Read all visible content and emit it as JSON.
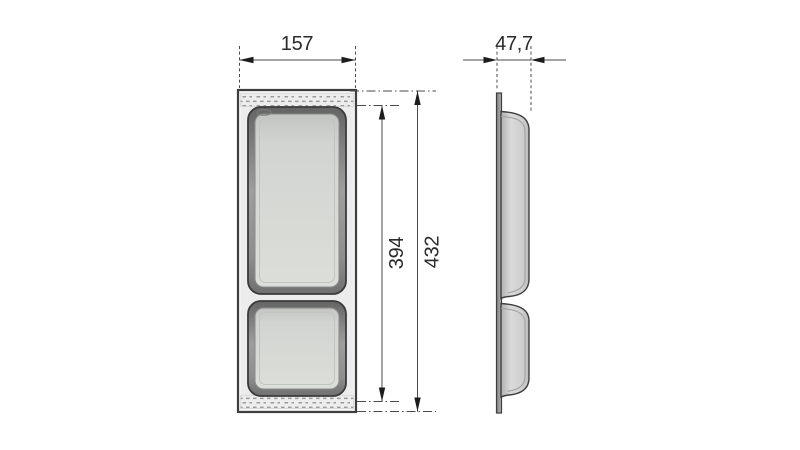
{
  "page": {
    "background": "#ffffff"
  },
  "drawing": {
    "type": "technical-dimension-drawing",
    "subject": "Drawer cutlery tray insert shown in front and side orthographic views",
    "views": {
      "front": {
        "name": "front-view",
        "compartments": 2
      },
      "side": {
        "name": "side-profile-view"
      }
    },
    "dimensions": {
      "width": {
        "value": "157"
      },
      "depth": {
        "value": "47,7"
      },
      "inner_height": {
        "value": "394"
      },
      "overall_height": {
        "value": "432"
      }
    },
    "colors": {
      "line": "#3e3e3e",
      "dimension_line": "#4a4a4a",
      "arrow": "#1c1c1c",
      "tray_fill": "#ececec",
      "rim_dark": "#686868",
      "rim_light": "#a8a8a8",
      "floor_fill": "#d5d7d4",
      "texture_dot": "#9b9b9b"
    }
  }
}
